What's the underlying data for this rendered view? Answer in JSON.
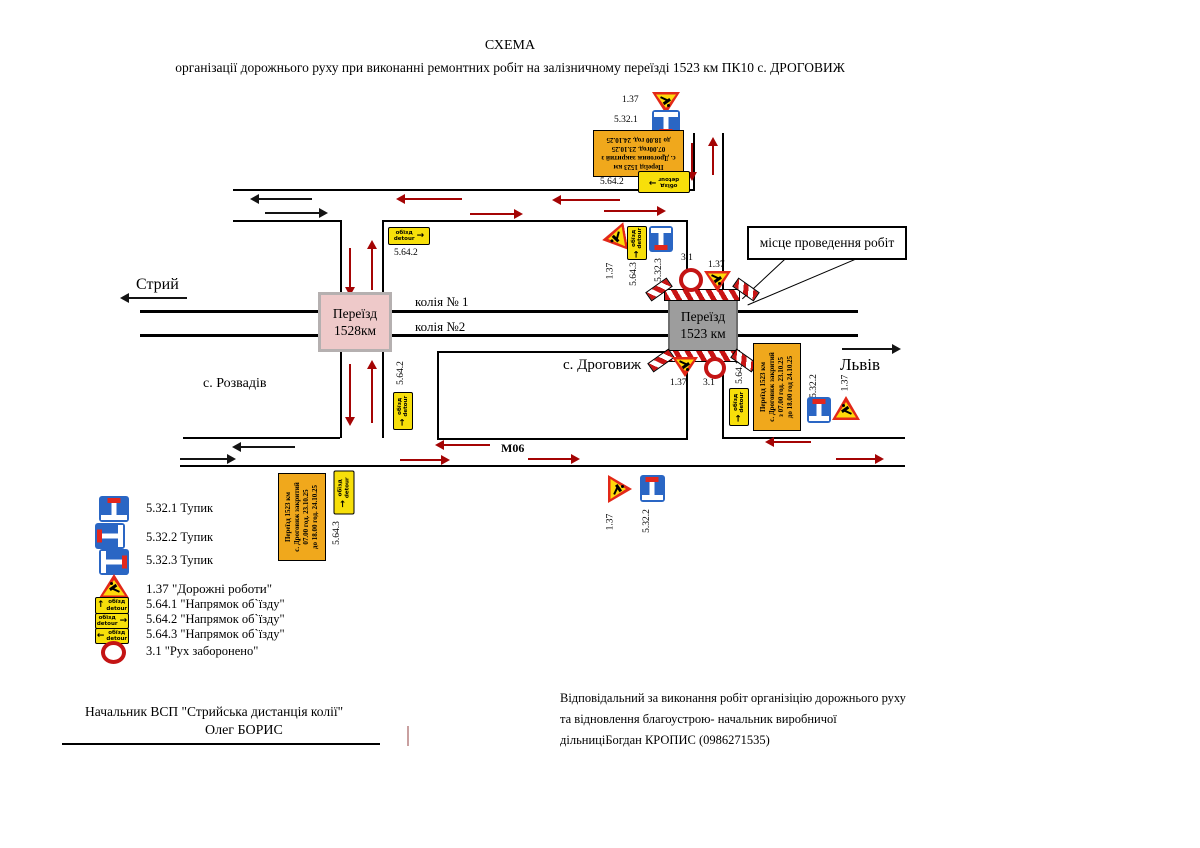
{
  "title": {
    "line1": "СХЕМА",
    "line2": "організації дорожнього руху при виконанні ремонтних робіт на залізничному переїзді 1523 км ПК10 с. ДРОГОВИЖ"
  },
  "map": {
    "callout": "місце проведення робіт",
    "road": "М06",
    "towns": {
      "stryi": "Стрий",
      "rozvadiv": "с. Розвадів",
      "drohovyzh": "с. Дроговиж",
      "lviv": "Львів"
    },
    "tracks": {
      "t1": "колія № 1",
      "t2": "колія №2"
    },
    "crossing_left": {
      "l1": "Переїзд",
      "l2": "1528км"
    },
    "crossing_right": {
      "l1": "Переїзд",
      "l2": "1523 км"
    },
    "boards": {
      "top": [
        "Переїзд 1523 км",
        "с. Дроговиж закритий з",
        "07.00год. 23.10.25",
        "до 18.00 год. 24.10.25"
      ],
      "right": [
        "Переїзд 1523 км",
        "с. Дроговиж закритий",
        "з 07.00 год. 23.10.25",
        "до 18.00 год 24.10.25"
      ],
      "bottom": [
        "Переїзд 1523 км",
        "с. Дроговиж закритий",
        "07.00 год. 23.10.25",
        "до 18.00 год. 24.10.25"
      ]
    }
  },
  "labels": {
    "s137": "1.37",
    "s5321": "5.32.1",
    "s5322": "5.32.2",
    "s5323": "5.32.3",
    "s5641": "5.64.1",
    "s5642": "5.64.2",
    "s5643": "5.64.3",
    "s31": "3.1"
  },
  "detour": {
    "word1": "обїзд",
    "word2": "detour"
  },
  "icons": {
    "arrow_up": "↑",
    "arrow_right": "→",
    "arrow_left": "←"
  },
  "legend": {
    "items": [
      "5.32.1 Тупик",
      "5.32.2 Тупик",
      "5.32.3 Тупик",
      "1.37 \"Дорожні роботи\"",
      "5.64.1 \"Напрямок об`їзду\"",
      "5.64.2 \"Напрямок об`їзду\"",
      "5.64.3 \"Напрямок об`їзду\"",
      "3.1 \"Рух заборонено\""
    ]
  },
  "signatures": {
    "left": [
      "Начальник ВСП \"Стрийська дистанція колії\"",
      "Олег БОРИС"
    ],
    "right": [
      "Відповідальний за виконання робіт організіцію дорожнього руху",
      "та відновлення благоустрою- начальник виробничої",
      "дільниціБогдан КРОПИС (0986271535)"
    ]
  },
  "colors": {
    "sign_yellow": "#f7df0a",
    "board_orange": "#f0a81c",
    "sign_blue": "#2a66c4",
    "sign_red_cap": "#e3271c",
    "barrier_red": "#c81414",
    "crossing_pink": "#eec9c9",
    "crossing_gray": "#9d9d9d",
    "arrow_red": "#a40404",
    "arrow_black": "#141414"
  }
}
